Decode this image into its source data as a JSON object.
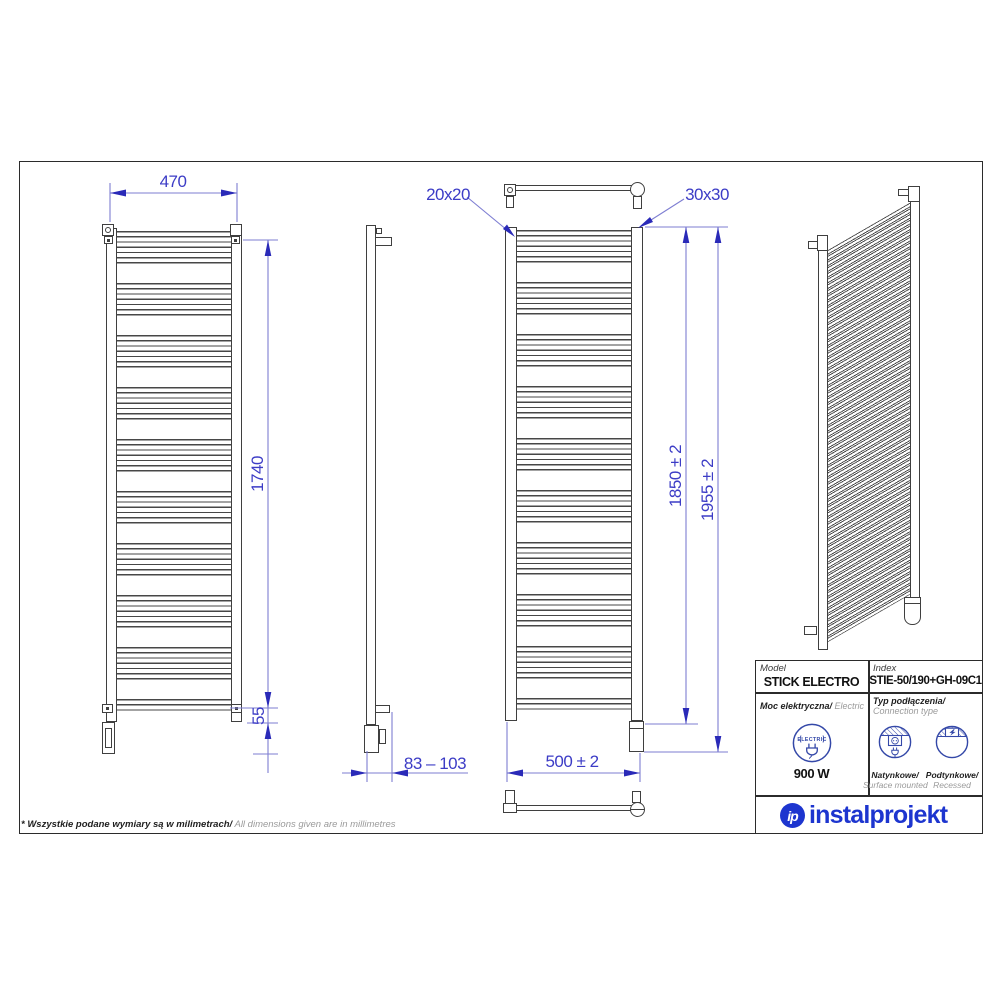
{
  "views": {
    "front": {
      "width": "470",
      "height": "1740",
      "bottom_offset": "55"
    },
    "side": {
      "depth": "83 – 103"
    },
    "connections": {
      "tube_profile": "20x20",
      "collector_profile": "30x30",
      "mount_height": "1850 ± 2",
      "total_height": "1955 ± 2",
      "width": "500 ± 2"
    }
  },
  "table": {
    "model_label": "Model",
    "model_value": "STICK ELECTRO",
    "index_label": "Index",
    "index_value": "STIE-50/190+GH-09C1",
    "power_label_pl": "Moc elektryczna/",
    "power_label_en": " Electric power",
    "power_value": "900 W",
    "electric_badge": "ELECTRIC",
    "connection_label_pl": "Typ podłączenia/",
    "connection_label_en": "Connection type",
    "surface_label_pl": "Natynkowe/",
    "surface_label_en": "Surface mounted",
    "recessed_label_pl": "Podtynkowe/",
    "recessed_label_en": "Recessed"
  },
  "logo": {
    "monogram": "ip",
    "wordmark": "instalprojekt"
  },
  "footnote": {
    "pl": "* Wszystkie podane wymiary są w milimetrach/",
    "en": " All dimensions given are in millimetres"
  },
  "colors": {
    "dimension_blue": "#3c3cc6",
    "drawing_gray": "#3f3f3f",
    "brand_blue": "#1d35cf",
    "icon_navy": "#3448a8"
  }
}
